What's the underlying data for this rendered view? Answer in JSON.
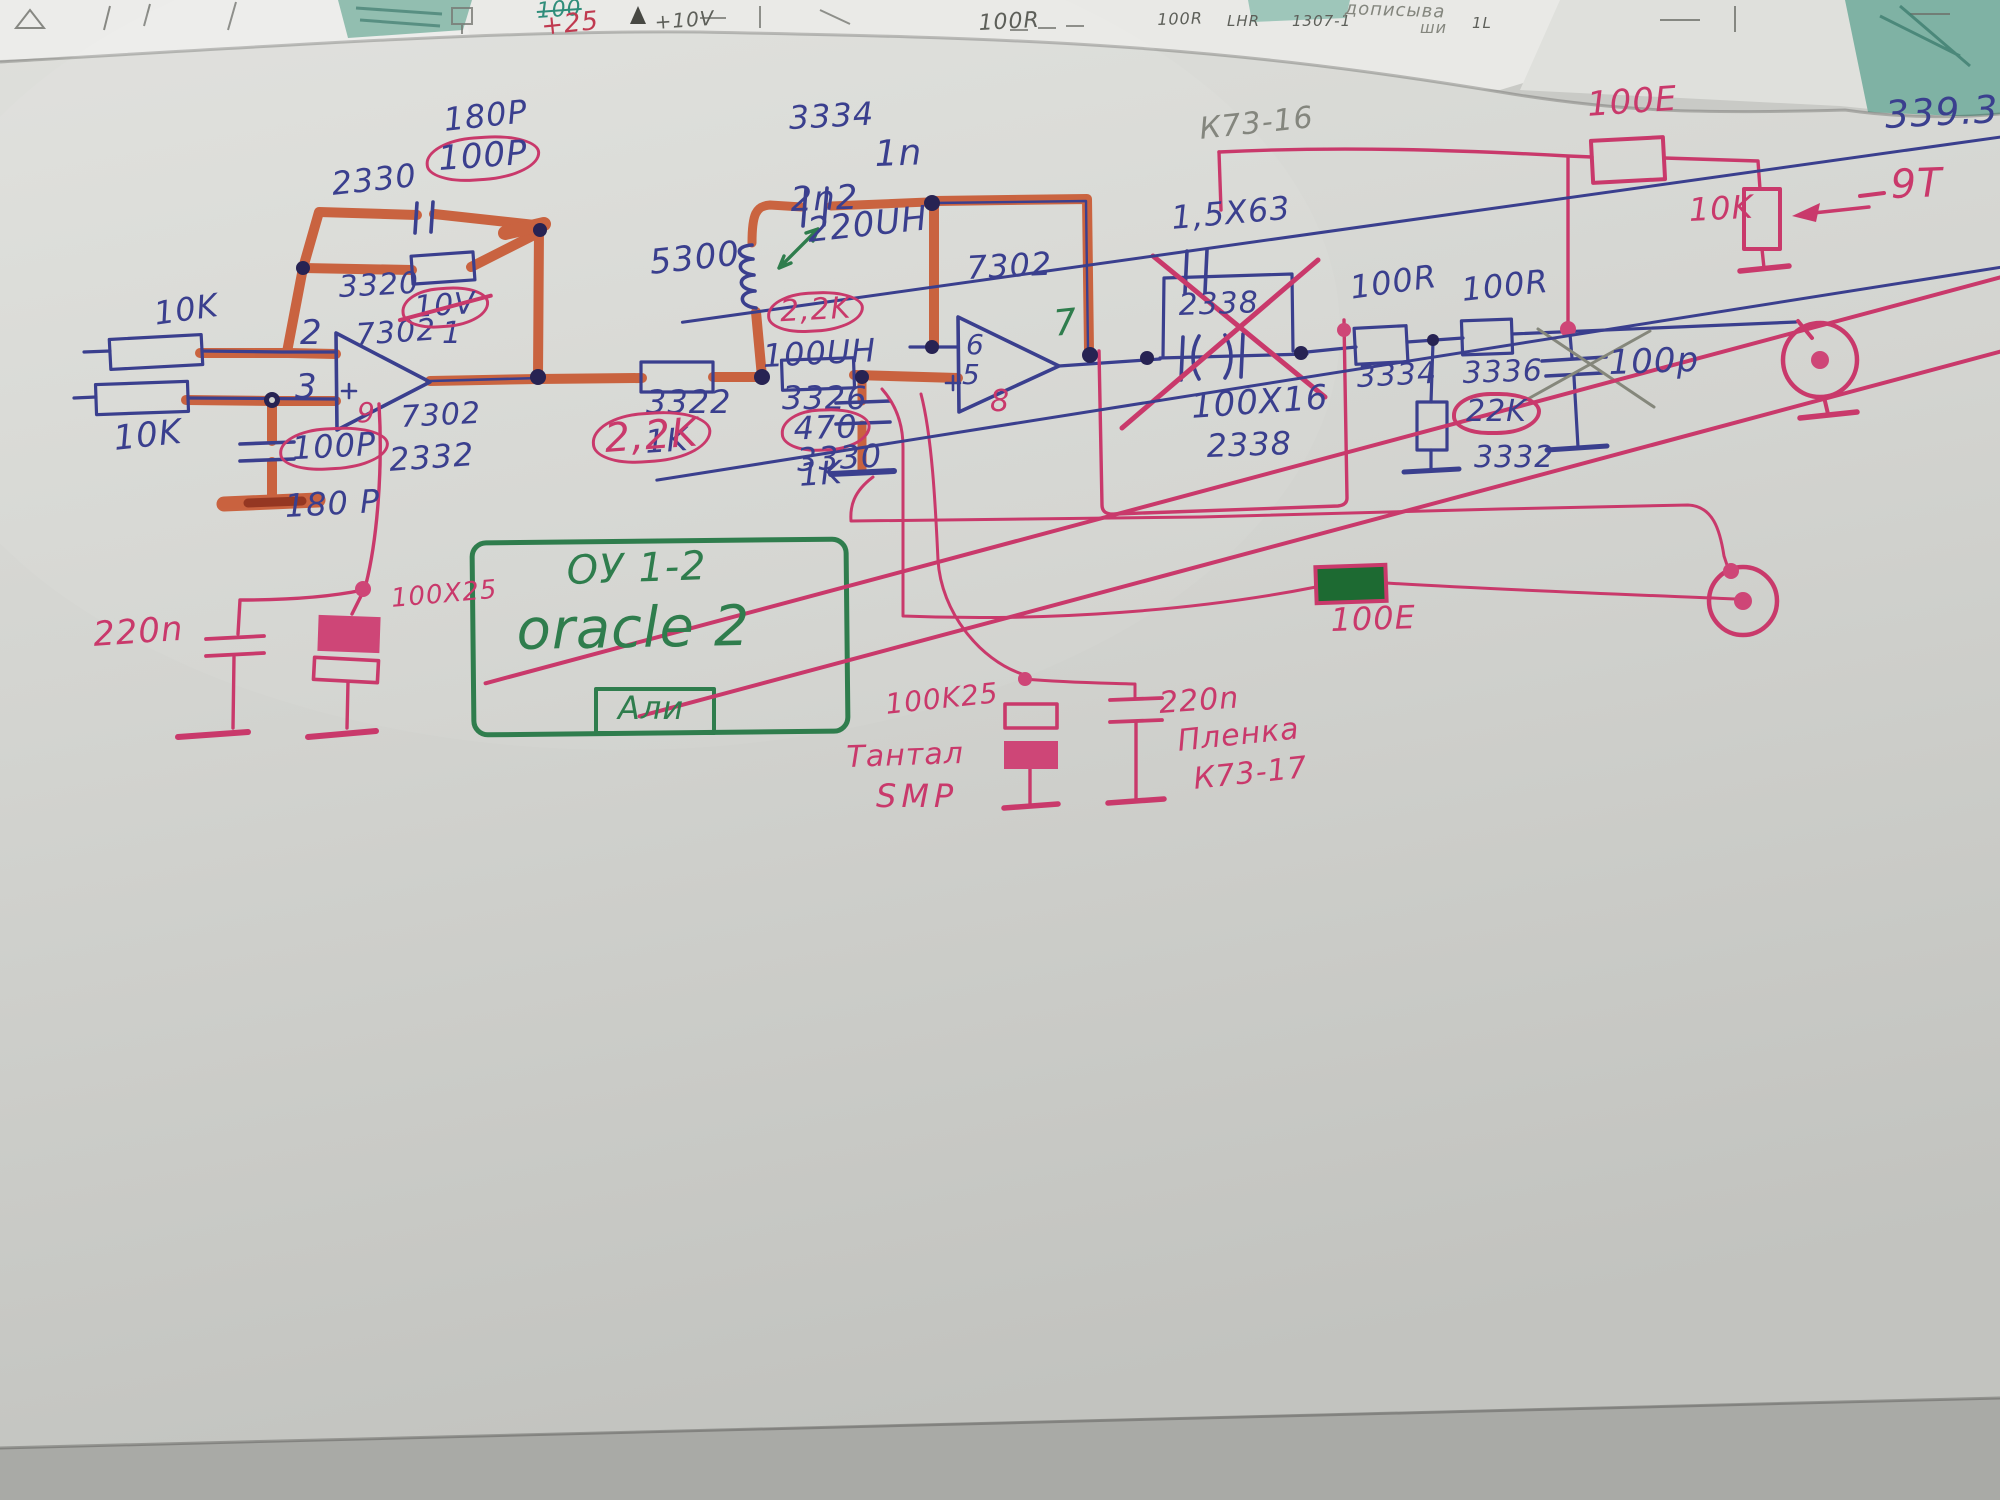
{
  "colors": {
    "blue_pen": "#3a3f8e",
    "pink_pen": "#c9396b",
    "red_marker": "#c6491f",
    "green_pen": "#2f7d4d",
    "pencil": "#84867e",
    "paper": "#d2d3cf"
  },
  "background_fragments": {
    "a": "100",
    "b": "+25",
    "c": "+10V",
    "d": "100R",
    "e": "100R",
    "f": "LHR",
    "g": "1307-1",
    "h": "1L",
    "i": "дописыва",
    "j": "ши"
  },
  "stage1": {
    "r_in_top": "10K",
    "r_in_bottom": "10K",
    "pin_inverting": "2",
    "pin_noninverting": "3",
    "opamp_type": "7302",
    "pin_output": "1",
    "opamp_type_sub": "7302",
    "pin_bias": "9",
    "fb_cap_ref": "2330",
    "fb_cap_new": "180P",
    "fb_cap_old": "100P",
    "fb_res_ref": "3320",
    "fb_res_old": "10V",
    "in_cap_old": "100P",
    "in_cap_ref": "2332",
    "in_cap_new": "180 P",
    "bias_cap_film": "220n",
    "bias_cap_elec": "100X25"
  },
  "stage2": {
    "cap_ref": "3334",
    "cap_old": "2n2",
    "cap_new": "1n",
    "coil_ref": "5300",
    "coil_val": "220UH",
    "coil_old": "100UH",
    "r1_old": "1K",
    "r1_ref": "3322",
    "r1_new": "2,2K",
    "r1_new_alt": "2,2K",
    "r2_old": "1K",
    "r2_ref": "3326",
    "r2_new": "470",
    "shunt_cap_ref": "3330",
    "opamp_type": "7302",
    "pin_inverting": "6",
    "pin_noninverting": "5",
    "pin_output": "7",
    "pin_bias": "8"
  },
  "crossed_out": {
    "film_type": "К73-16",
    "film_val": "1,5X63",
    "film_ref": "2338",
    "elec_val": "100X16",
    "elec_ref": "2338"
  },
  "output_stage": {
    "r1_val": "100R",
    "r2_val": "100R",
    "r1_ref": "3334",
    "r2_ref": "3336",
    "gnd_res_val": "22K",
    "gnd_res_ref": "3332",
    "cap_val": "100p"
  },
  "top_right": {
    "res_val": "100E",
    "pot_val": "10K",
    "note_blue": "339.3",
    "note_pink": "9Т"
  },
  "bias_network": {
    "cap1_val": "100K25",
    "cap1_type": "Тантал",
    "cap1_mount": "SMP",
    "cap2_val": "220n",
    "cap2_type": "Пленка",
    "cap2_series": "К73-17"
  },
  "mid_wire": {
    "res_val": "100E"
  },
  "title_box": {
    "line1": "ОУ 1-2",
    "line2": "oracle 2",
    "line3": "Али"
  }
}
